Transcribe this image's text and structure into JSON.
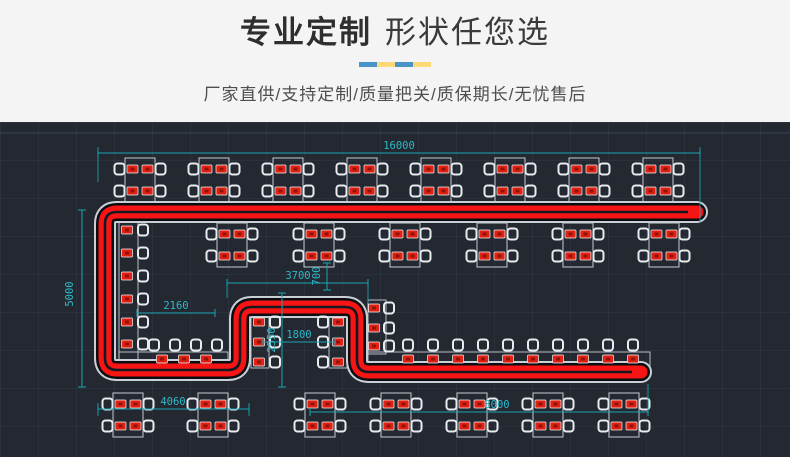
{
  "header": {
    "title_bold": "专业定制",
    "title_regular": "形状任您选",
    "subtitle": "厂家直供/支持定制/质量把关/质保期长/无忧售后",
    "divider_colors": [
      "#4a93c8",
      "#fdd977",
      "#4a93c8",
      "#fdd977"
    ],
    "background": "#f4f4f5",
    "title_color": "#2e2e2e",
    "subtitle_color": "#4e4e4e"
  },
  "drawing": {
    "description": "CAD floor plan of custom rotary conveyor belt layout with dining tables, chairs and plates",
    "background": "#232831",
    "belt_color": "#f61414",
    "belt_outline_color": "#0a0d11",
    "belt_halo_color": "#c9cfd5",
    "dimension_color": "#1ba5b5",
    "dimension_text_color": "#2cbac8",
    "furniture_line_color": "#c9ced3",
    "plate_color": "#e32112",
    "track": {
      "path": "M 697 90 L 117 90 Q 105 90 105 102 L 105 236 Q 105 248 117 248 L 228 248 Q 240 248 240 236 L 240 197 Q 240 185 252 185 L 345 185 Q 357 185 357 197 L 357 238 Q 357 250 369 250 L 641 250",
      "slot_path": "M 688 90 L 117 90 Q 105 90 105 102 L 105 236 Q 105 248 117 248 L 228 248 Q 240 248 240 236 L 240 197 Q 240 185 252 185 L 345 185 Q 357 185 357 197 L 357 238 Q 357 250 369 250 L 632 250"
    },
    "counters": [
      [
        119,
        98,
        19,
        146
      ],
      [
        119,
        230,
        109,
        14
      ],
      [
        251,
        193,
        18,
        53
      ],
      [
        329,
        193,
        18,
        53
      ],
      [
        368,
        178,
        18,
        54
      ],
      [
        368,
        230,
        282,
        14
      ]
    ],
    "tables": {
      "w": 30,
      "h": 44,
      "plate_dx": 7.5,
      "plate_dy": 11,
      "chair_dx": 20.5,
      "chair_dy": 11,
      "rows": [
        {
          "y": 58,
          "xs": [
            140,
            214,
            288,
            362,
            436,
            510,
            584,
            658
          ]
        },
        {
          "y": 123,
          "xs": [
            232,
            319,
            405,
            492,
            578,
            664
          ]
        },
        {
          "y": 293,
          "xs": [
            128,
            213,
            320,
            396,
            472,
            548,
            624
          ]
        }
      ]
    },
    "plates": [
      {
        "x": 127,
        "ys": [
          108,
          131,
          154,
          177,
          200,
          222
        ]
      },
      {
        "x": 259,
        "ys": [
          200,
          220,
          240
        ]
      },
      {
        "x": 338,
        "ys": [
          200,
          220,
          240
        ]
      },
      {
        "x": 374,
        "ys": [
          186,
          206,
          224
        ]
      },
      {
        "y": 237,
        "xs": [
          162,
          184,
          206
        ]
      },
      {
        "y": 237,
        "xs": [
          408,
          433,
          458,
          483,
          508,
          533,
          558,
          583,
          608,
          633
        ]
      }
    ],
    "chairs": [
      {
        "x": 143,
        "ys": [
          108,
          131,
          154,
          177,
          200,
          222
        ]
      },
      {
        "x": 275,
        "ys": [
          200,
          220,
          240
        ]
      },
      {
        "x": 323,
        "ys": [
          200,
          220,
          240
        ]
      },
      {
        "x": 389,
        "ys": [
          186,
          206,
          224
        ]
      },
      {
        "y": 223,
        "xs": [
          154,
          175,
          196,
          217
        ]
      },
      {
        "y": 223,
        "xs": [
          408,
          433,
          458,
          483,
          508,
          533,
          558,
          583,
          608,
          633
        ]
      }
    ],
    "dims": [
      {
        "label": "16000",
        "x1": 98,
        "y1": 31,
        "x2": 700,
        "y2": 31,
        "lx": 399,
        "ly": 27,
        "ext": [
          [
            98,
            25,
            98,
            60
          ],
          [
            700,
            25,
            700,
            100
          ]
        ]
      },
      {
        "label": "5000",
        "x1": 82,
        "y1": 88,
        "x2": 82,
        "y2": 265,
        "lx": 73,
        "ly": 172,
        "rot": true
      },
      {
        "label": "3700",
        "x1": 227,
        "y1": 161,
        "x2": 368,
        "y2": 161,
        "lx": 298,
        "ly": 157,
        "ext": [
          [
            227,
            161,
            227,
            176
          ],
          [
            368,
            161,
            368,
            181
          ]
        ]
      },
      {
        "label": "700",
        "x1": 327,
        "y1": 141,
        "x2": 327,
        "y2": 168,
        "lx": 320,
        "ly": 154,
        "rot": true
      },
      {
        "label": "2160",
        "x1": 137,
        "y1": 191,
        "x2": 215,
        "y2": 191,
        "lx": 176,
        "ly": 187
      },
      {
        "label": "1800",
        "x1": 263,
        "y1": 220,
        "x2": 335,
        "y2": 220,
        "lx": 299,
        "ly": 216
      },
      {
        "label": "2550",
        "x1": 282,
        "y1": 171,
        "x2": 282,
        "y2": 265,
        "lx": 275,
        "ly": 218,
        "rot": true
      },
      {
        "label": "4060",
        "x1": 98,
        "y1": 287,
        "x2": 249,
        "y2": 287,
        "lx": 173,
        "ly": 283,
        "ext": [
          [
            98,
            281,
            98,
            294
          ],
          [
            249,
            281,
            249,
            294
          ]
        ]
      },
      {
        "label": "8000",
        "x1": 310,
        "y1": 290,
        "x2": 648,
        "y2": 290,
        "lx": 497,
        "ly": 286,
        "ext": [
          [
            648,
            262,
            648,
            294
          ]
        ]
      }
    ]
  }
}
